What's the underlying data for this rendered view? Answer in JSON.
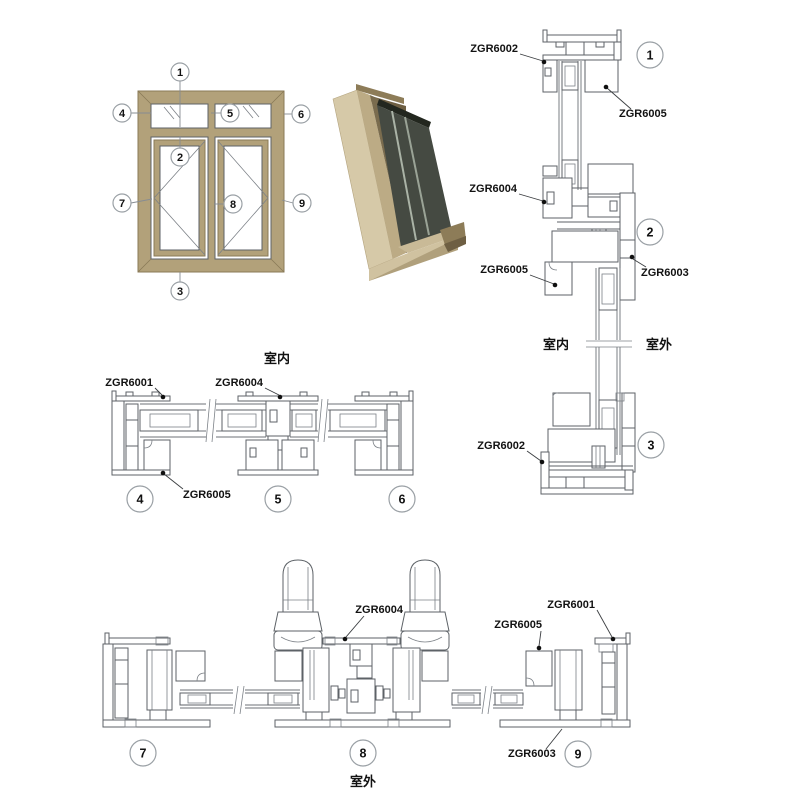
{
  "labels": {
    "zgr6001": "ZGR6001",
    "zgr6002": "ZGR6002",
    "zgr6003": "ZGR6003",
    "zgr6004": "ZGR6004",
    "zgr6005": "ZGR6005"
  },
  "zones": {
    "indoor": "室内",
    "outdoor": "室外"
  },
  "callouts": {
    "n1": "1",
    "n2": "2",
    "n3": "3",
    "n4": "4",
    "n5": "5",
    "n6": "6",
    "n7": "7",
    "n8": "8",
    "n9": "9"
  },
  "colors": {
    "frame_tan": "#b2a17a",
    "frame_tan_dark": "#8a7a57",
    "render_light": "#d6c9a8",
    "render_mid": "#bcab85",
    "render_dark": "#7a6c4e",
    "glass_dark": "#454a42",
    "section_line": "#5d6267",
    "callout_ring": "#9aa0a5"
  }
}
